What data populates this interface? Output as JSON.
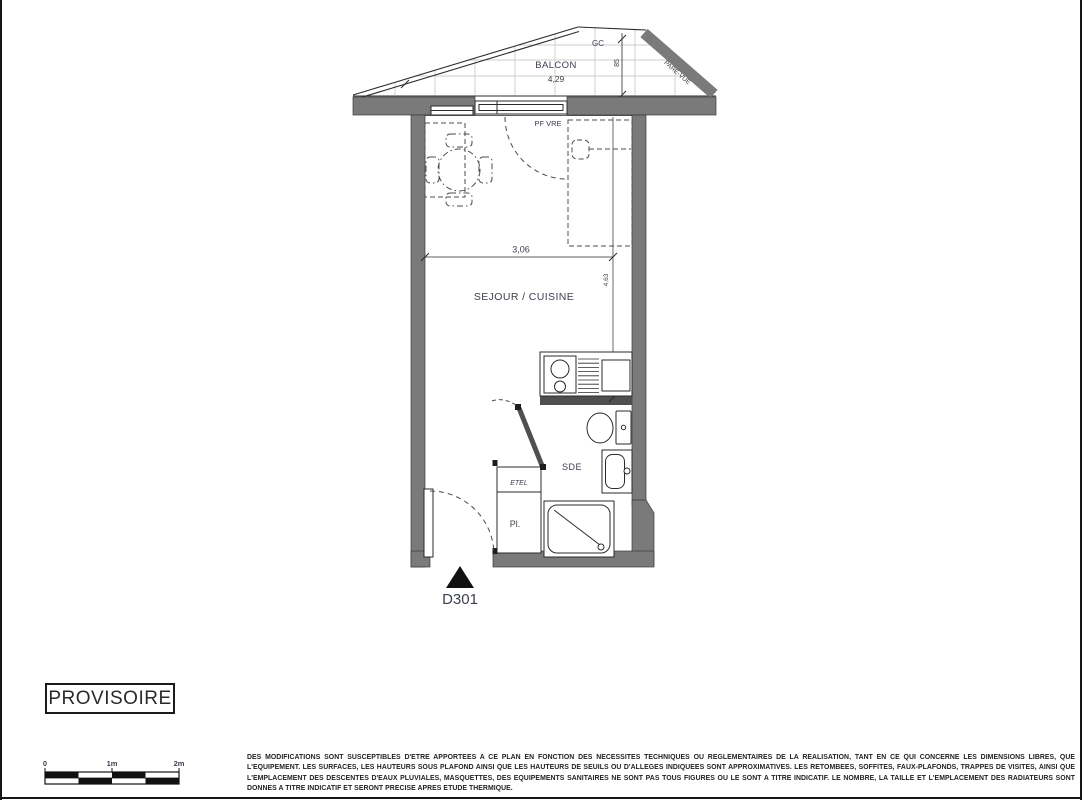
{
  "plan": {
    "balcony": {
      "label": "BALCON",
      "length": "4,29",
      "depth": "85",
      "gc_label": "GC",
      "screen_label": "PARE-VUE"
    },
    "window_label": "PF VRE",
    "living": {
      "label": "SEJOUR / CUISINE",
      "width": "3,06",
      "depth": "4,63"
    },
    "shower_room_label": "SDE",
    "closet_label": "Pl.",
    "elec_label": "ETEL",
    "unit_label": "D301"
  },
  "stamp": {
    "text": "PROVISOIRE"
  },
  "scale_bar": {
    "start": "0",
    "mid": "1m",
    "end": "2m"
  },
  "disclaimer": {
    "text": "DES MODIFICATIONS SONT SUSCEPTIBLES D'ETRE APPORTEES A CE PLAN EN FONCTION DES NECESSITES TECHNIQUES OU REGLEMENTAIRES DE LA REALISATION, TANT EN CE QUI CONCERNE LES DIMENSIONS LIBRES, QUE L'EQUIPEMENT. LES SURFACES, LES HAUTEURS SOUS PLAFOND AINSI QUE LES HAUTEURS DE SEUILS OU D'ALLEGES INDIQUEES SONT APPROXIMATIVES. LES RETOMBEES, SOFFITES, FAUX-PLAFONDS, TRAPPES DE VISITES, AINSI QUE L'EMPLACEMENT DES DESCENTES D'EAUX PLUVIALES, MASQUETTES, DES EQUIPEMENTS SANITAIRES NE SONT PAS TOUS FIGURES OU LE SONT A TITRE INDICATIF. LE NOMBRE, LA TAILLE ET L'EMPLACEMENT DES RADIATEURS SONT DONNES A TITRE INDICATIF ET SERONT PRECISE APRES ETUDE THERMIQUE."
  },
  "colors": {
    "wall": "#7a7a7a",
    "partition": "#4f4f4f",
    "line": "#2b2b2b",
    "label": "#3b404e"
  }
}
